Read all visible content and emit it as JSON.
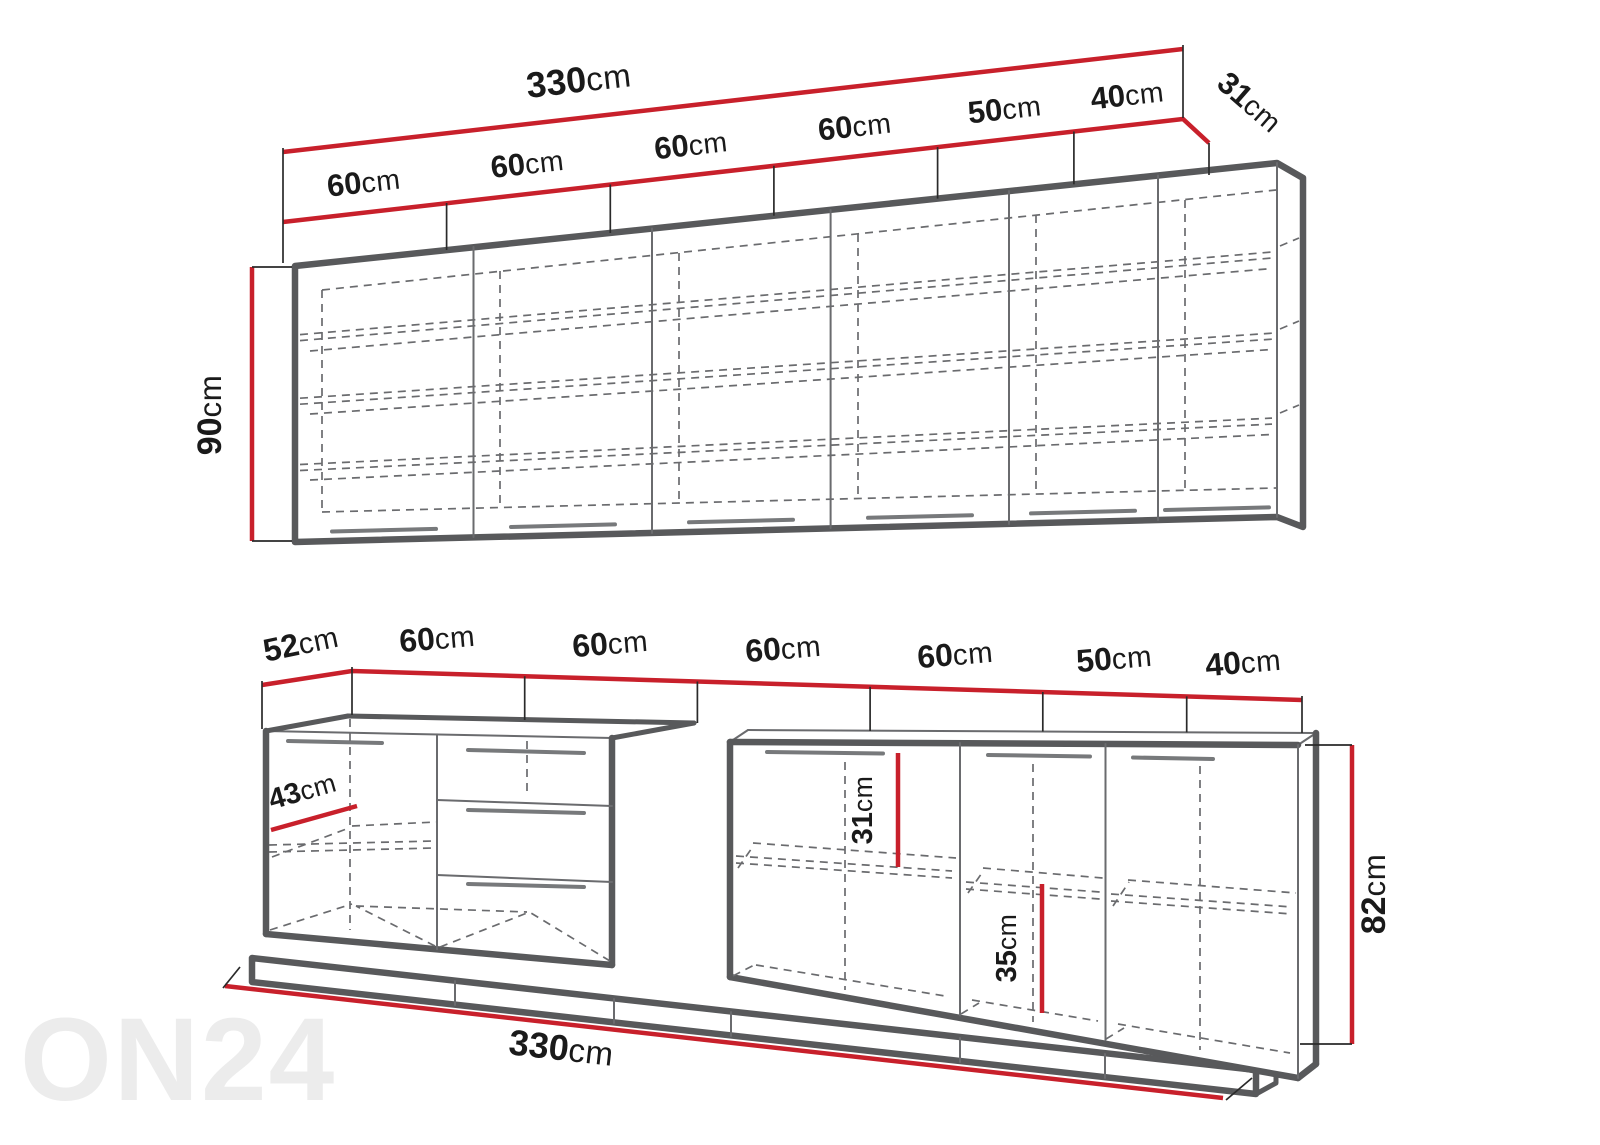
{
  "watermark": {
    "text": "ON24"
  },
  "upper": {
    "total": {
      "num": "330",
      "unit": "cm"
    },
    "segments": [
      {
        "num": "60",
        "unit": "cm"
      },
      {
        "num": "60",
        "unit": "cm"
      },
      {
        "num": "60",
        "unit": "cm"
      },
      {
        "num": "60",
        "unit": "cm"
      },
      {
        "num": "50",
        "unit": "cm"
      },
      {
        "num": "40",
        "unit": "cm"
      }
    ],
    "depth": {
      "num": "31",
      "unit": "cm"
    },
    "height": {
      "num": "90",
      "unit": "cm"
    }
  },
  "lower": {
    "counter_depth": {
      "num": "52",
      "unit": "cm"
    },
    "segments": [
      {
        "num": "60",
        "unit": "cm"
      },
      {
        "num": "60",
        "unit": "cm"
      },
      {
        "num": "60",
        "unit": "cm"
      },
      {
        "num": "60",
        "unit": "cm"
      },
      {
        "num": "50",
        "unit": "cm"
      },
      {
        "num": "40",
        "unit": "cm"
      }
    ],
    "inner_depth": {
      "num": "43",
      "unit": "cm"
    },
    "shelf_top_gap": {
      "num": "31",
      "unit": "cm"
    },
    "shelf_bottom_gap": {
      "num": "35",
      "unit": "cm"
    },
    "height": {
      "num": "82",
      "unit": "cm"
    },
    "total": {
      "num": "330",
      "unit": "cm"
    }
  },
  "colors": {
    "dimension_red": "#C8202B",
    "outline_gray": "#58595B",
    "detail_gray": "#6A6B6E",
    "text_black": "#1A1A1A",
    "watermark_gray": "#ECECEC"
  }
}
